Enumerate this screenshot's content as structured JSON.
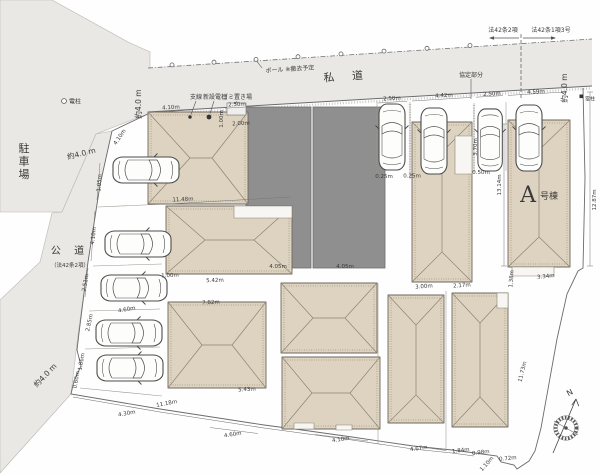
{
  "site_plan": {
    "area_labels": [
      {
        "name": "parking-lot-label",
        "text": "駐車場",
        "x": 24,
        "y": 152,
        "size": 11,
        "vertical": true,
        "color": "#333333"
      },
      {
        "name": "private-road-label",
        "text": "私 道",
        "x": 347,
        "y": 80,
        "size": 11,
        "rot": -4,
        "spacing": 7,
        "color": "#333333"
      },
      {
        "name": "public-road-label",
        "text": "公 道",
        "x": 70,
        "y": 254,
        "size": 10,
        "spacing": 5,
        "color": "#333333"
      },
      {
        "name": "public-road-note",
        "text": "（法42条2項）",
        "x": 70,
        "y": 267,
        "size": 5.5,
        "color": "#444444"
      },
      {
        "name": "building-a-letter",
        "text": "A",
        "x": 528,
        "y": 202,
        "size": 22,
        "color": "#2f6e33",
        "serif": true
      },
      {
        "name": "building-a-suffix",
        "text": "号棟",
        "x": 549,
        "y": 199,
        "size": 9,
        "color": "#2f6e33"
      },
      {
        "name": "road-law-left-label",
        "text": "法42条2項",
        "x": 503,
        "y": 32,
        "size": 6
      },
      {
        "name": "road-law-right-label",
        "text": "法42条1項3号",
        "x": 551,
        "y": 32,
        "size": 6
      },
      {
        "name": "road-width-top-left",
        "text": "約4.0 m",
        "x": 141,
        "y": 104,
        "size": 7.5,
        "rot": -90
      },
      {
        "name": "road-width-top-right",
        "text": "約4.0 m",
        "x": 567,
        "y": 88,
        "size": 7.5,
        "rot": -90
      },
      {
        "name": "road-width-left",
        "text": "約4.0 m",
        "x": 82,
        "y": 156,
        "size": 7.5,
        "rot": -14
      },
      {
        "name": "road-width-bottom-left",
        "text": "約4.0 m",
        "x": 47,
        "y": 377,
        "size": 7.5,
        "rot": -46
      },
      {
        "name": "utility-pole-left-label",
        "text": "電柱",
        "x": 69,
        "y": 103.5,
        "size": 6,
        "anchor": "start"
      },
      {
        "name": "utility-pole-right-label",
        "text": "電柱",
        "x": 585,
        "y": 100.5,
        "size": 5,
        "anchor": "start"
      },
      {
        "name": "pole-removal-note",
        "text": "ポール ※撤去予定",
        "x": 290,
        "y": 71,
        "size": 6,
        "rot": -4
      },
      {
        "name": "agreement-part-label",
        "text": "協定部分",
        "x": 471,
        "y": 77,
        "size": 6
      },
      {
        "name": "guy-wire-label",
        "text": "支線",
        "x": 196,
        "y": 99,
        "size": 6
      },
      {
        "name": "new-pole-label",
        "text": "新設電柱",
        "x": 215,
        "y": 99,
        "size": 6
      },
      {
        "name": "garbage-area-label",
        "text": "ゴミ置き場",
        "x": 237,
        "y": 99,
        "size": 6
      },
      {
        "name": "compass-north-label",
        "text": "N",
        "x": 571,
        "y": 395,
        "size": 8,
        "rot": -28
      }
    ],
    "dimension_labels": [
      {
        "t": "4.10m",
        "x": 171,
        "y": 109,
        "r": -3
      },
      {
        "t": "2.50m",
        "x": 237,
        "y": 106,
        "r": -3
      },
      {
        "t": "1.00m",
        "x": 223,
        "y": 119,
        "r": -90
      },
      {
        "t": "2.00m",
        "x": 241,
        "y": 125,
        "r": -3
      },
      {
        "t": "11.48m",
        "x": 183,
        "y": 201,
        "r": -3
      },
      {
        "t": "1.00m",
        "x": 170,
        "y": 277,
        "r": -2
      },
      {
        "t": "5.42m",
        "x": 215,
        "y": 282,
        "r": -2
      },
      {
        "t": "7.82m",
        "x": 211,
        "y": 304,
        "r": -3
      },
      {
        "t": "5.43m",
        "x": 247,
        "y": 391,
        "r": -3
      },
      {
        "t": "4.05m",
        "x": 278,
        "y": 268,
        "r": 0,
        "c": "#d9d9d9"
      },
      {
        "t": "4.05m",
        "x": 345,
        "y": 268,
        "r": 0,
        "c": "#d9d9d9"
      },
      {
        "t": "2.50m",
        "x": 392,
        "y": 100,
        "r": -3
      },
      {
        "t": "4.42m",
        "x": 444,
        "y": 97,
        "r": -3
      },
      {
        "t": "2.50m",
        "x": 492,
        "y": 95.5,
        "r": -3
      },
      {
        "t": "4.59m",
        "x": 536,
        "y": 93.5,
        "r": -3
      },
      {
        "t": "0.25m",
        "x": 384,
        "y": 178
      },
      {
        "t": "0.25m",
        "x": 412,
        "y": 177.5
      },
      {
        "t": "0.50m",
        "x": 481,
        "y": 174
      },
      {
        "t": "3.70m",
        "x": 477,
        "y": 147,
        "r": -90
      },
      {
        "t": "13.14m",
        "x": 501,
        "y": 185,
        "r": -90
      },
      {
        "t": "12.87m",
        "x": 596,
        "y": 200,
        "r": -90
      },
      {
        "t": "3.00m",
        "x": 424,
        "y": 288,
        "r": -4
      },
      {
        "t": "2.17m",
        "x": 462,
        "y": 287,
        "r": -4
      },
      {
        "t": "3.34m",
        "x": 546,
        "y": 278,
        "r": -6
      },
      {
        "t": "1.38m",
        "x": 513,
        "y": 279,
        "r": -85
      },
      {
        "t": "11.73m",
        "x": 524,
        "y": 372,
        "r": -76
      },
      {
        "t": "4.10m",
        "x": 121,
        "y": 138,
        "r": -55
      },
      {
        "t": "1.05m",
        "x": 101,
        "y": 183,
        "r": -85
      },
      {
        "t": "4.10m",
        "x": 95,
        "y": 236,
        "r": -83
      },
      {
        "t": "2.51m",
        "x": 87,
        "y": 283,
        "r": -80
      },
      {
        "t": "2.85m",
        "x": 91,
        "y": 323,
        "r": -78
      },
      {
        "t": "1.86m",
        "x": 83,
        "y": 362,
        "r": -80
      },
      {
        "t": "0.60m",
        "x": 78,
        "y": 380,
        "r": -80
      },
      {
        "t": "4.60m",
        "x": 127,
        "y": 311,
        "r": -10
      },
      {
        "t": "4.30m",
        "x": 127,
        "y": 415,
        "r": -10
      },
      {
        "t": "11.18m",
        "x": 167,
        "y": 405,
        "r": -11
      },
      {
        "t": "4.60m",
        "x": 233,
        "y": 436,
        "r": -9
      },
      {
        "t": "4.10m",
        "x": 341,
        "y": 441,
        "r": -8
      },
      {
        "t": "4.67m",
        "x": 419,
        "y": 450,
        "r": -8
      },
      {
        "t": "1.84m",
        "x": 461,
        "y": 452,
        "r": -7
      },
      {
        "t": "0.98m",
        "x": 481,
        "y": 454,
        "r": -7
      },
      {
        "t": "0.72m",
        "x": 508,
        "y": 460,
        "r": -6
      },
      {
        "t": "1.10m",
        "x": 488,
        "y": 465,
        "r": -48
      }
    ],
    "colors": {
      "road_gray": "#e9e8e5",
      "building_beige": "#ddd3c0",
      "neighbor_gray": "#8f8f8f",
      "boundary_line": "#6b6b6b",
      "accent_green": "#2f6e33"
    }
  }
}
